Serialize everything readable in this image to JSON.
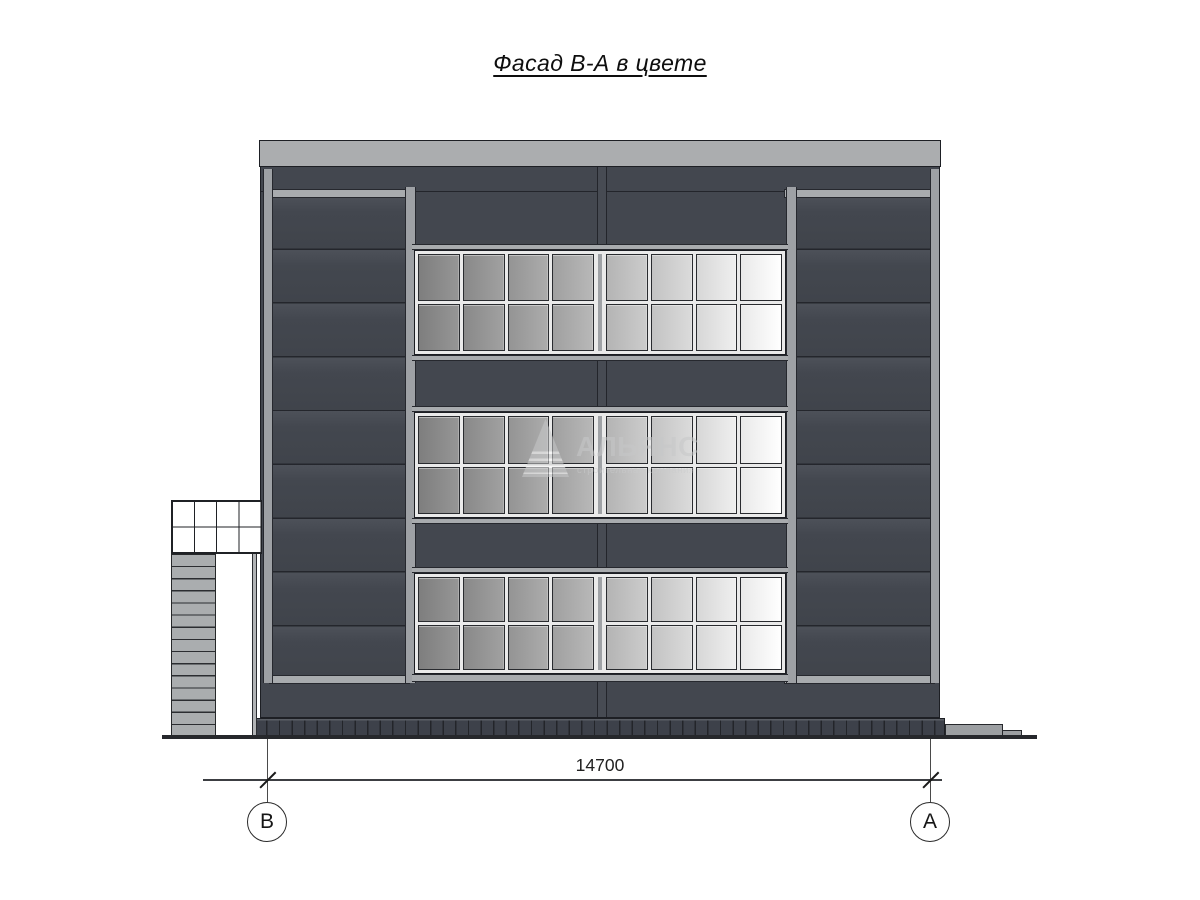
{
  "drawing": {
    "title": "Фасад В-А в цвете",
    "dimension_label": "14700",
    "axis_left": "В",
    "axis_right": "А"
  },
  "watermark": {
    "name": "АЛЬЯНС",
    "tagline": "строительная компания"
  },
  "building": {
    "window_bands": 3,
    "rows_per_band": 2,
    "panes_per_row": 8,
    "glass_ramp": [
      "#8b8b8b",
      "#969696",
      "#a1a1a1",
      "#adadad",
      "#c1c1c1",
      "#d0d0d0",
      "#e4e4e4",
      "#f6f6f6"
    ],
    "facade_color": "#43474f",
    "roof_color": "#abadaf",
    "trim_color": "#a8abae",
    "outline_color": "#1d1f24"
  }
}
